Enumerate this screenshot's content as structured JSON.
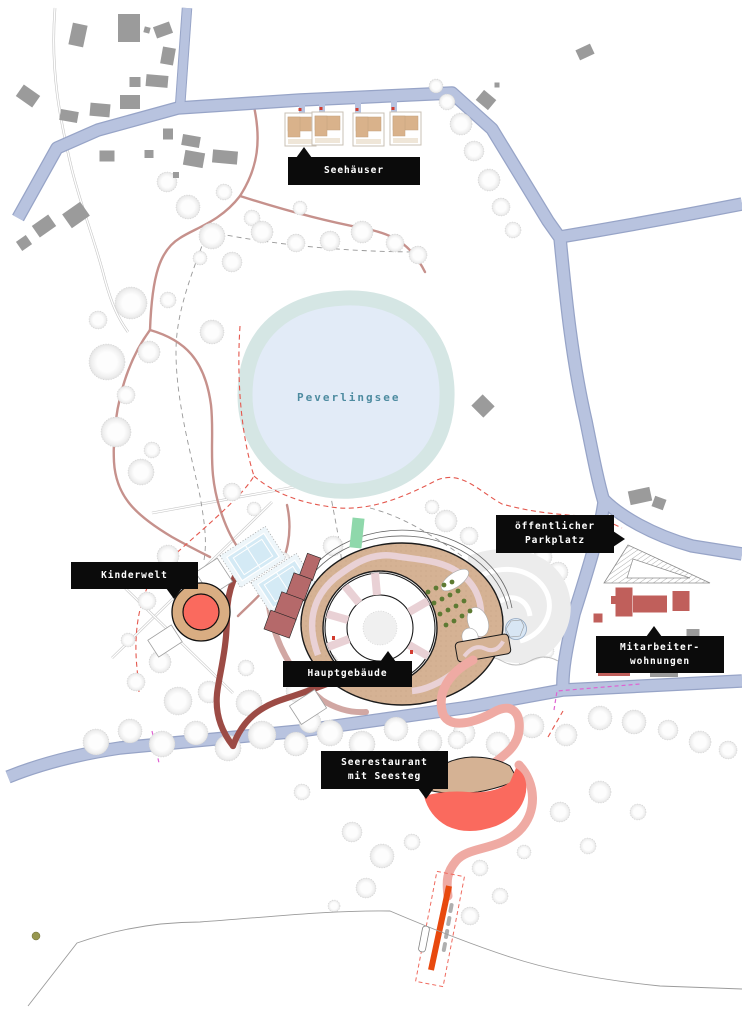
{
  "plan": {
    "lake_label": "Peverlingsee",
    "callouts": [
      {
        "id": "seehaeuser",
        "lines": [
          "Seehäuser"
        ]
      },
      {
        "id": "kinderwelt",
        "lines": [
          "Kinderwelt"
        ]
      },
      {
        "id": "hauptgebaeude",
        "lines": [
          "Hauptgebäude"
        ]
      },
      {
        "id": "oeffentlicher-parkplatz",
        "lines": [
          "öffentlicher",
          "Parkplatz"
        ]
      },
      {
        "id": "mitarbeiterwohnungen",
        "lines": [
          "Mitarbeiter-",
          "wohnungen"
        ]
      },
      {
        "id": "seerestaurant",
        "lines": [
          "Seerestaurant",
          "mit Seesteg"
        ]
      }
    ]
  },
  "colors": {
    "road_fill": "#b8c3df",
    "road_edge": "#97a4c7",
    "lake_band": "#d5e6e4",
    "lake_fill": "#e2ebf7",
    "lake_text": "#4d8ba0",
    "ring_tan": "#d5b294",
    "rose_path": "#c6918c",
    "pink_path": "#e9d1d5",
    "promenade_pink": "#efaaa3",
    "coral": "#fa6a5e",
    "dark_red": "#9c4b45",
    "staff_red": "#c05f5b",
    "pier_orange": "#e8490e",
    "building_gray": "#9b9b9b",
    "green_strip": "#8fd8ab",
    "green_dot": "#5d7a33",
    "tennis_blue": "#d4eaf5",
    "kinderwelt_ring": "#d9ad82",
    "callout_bg": "#0b0b0b",
    "callout_text": "#ffffff",
    "boundary_dash": "#e4584e",
    "magenta_dash": "#df63d2"
  }
}
